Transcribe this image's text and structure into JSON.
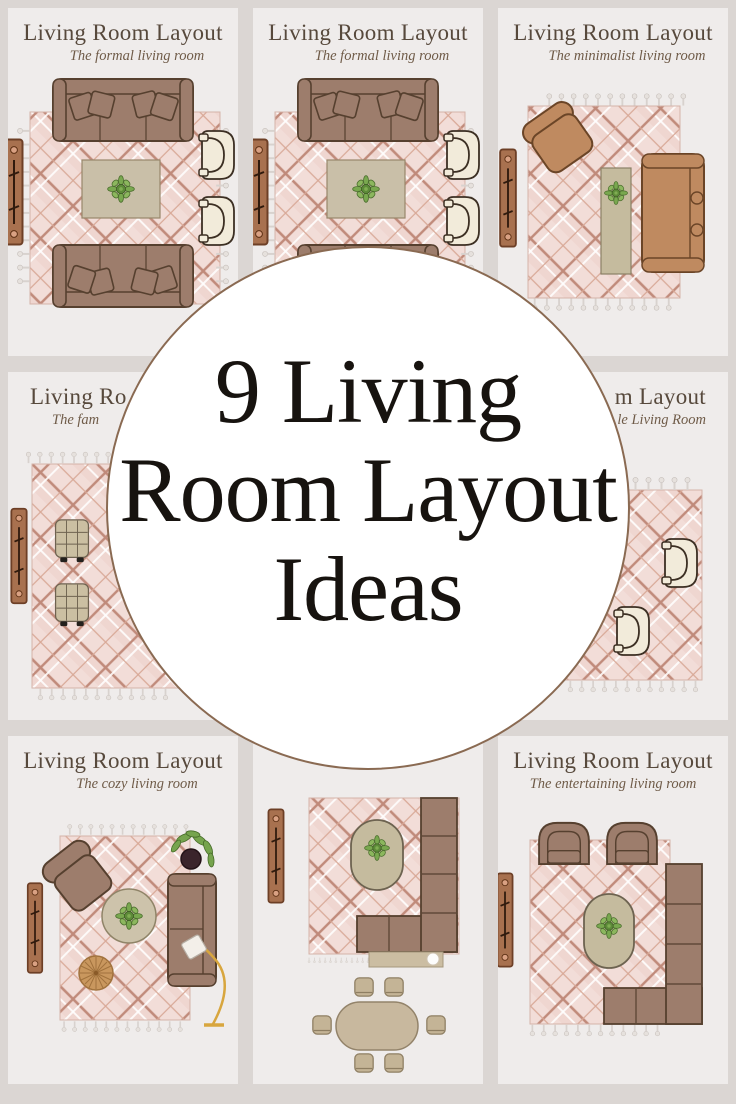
{
  "overlay": {
    "lines": [
      "9 Living",
      "Room Layout",
      "Ideas"
    ],
    "circle_fill": "#ffffff",
    "circle_border": "#8a6a52",
    "text_color": "#17130f"
  },
  "panels": [
    {
      "title": "Living Room Layout",
      "subtitle": "The formal living room",
      "furniture": [
        "plaid-rug",
        "sofa",
        "sofa",
        "coffee-table-with-plant",
        "accent-chair",
        "accent-chair",
        "console-table"
      ]
    },
    {
      "title": "Living Room Layout",
      "subtitle": "The formal living room",
      "furniture": [
        "plaid-rug",
        "sofa",
        "sofa",
        "coffee-table-with-plant",
        "accent-chair",
        "accent-chair",
        "console-table"
      ]
    },
    {
      "title": "Living Room Layout",
      "subtitle": "The minimalist living room",
      "furniture": [
        "plaid-rug",
        "swivel-accent-chair",
        "narrow-coffee-table-with-plant",
        "sofa",
        "console-table"
      ]
    },
    {
      "title": "Living Ro",
      "subtitle": "The fam",
      "furniture": [
        "plaid-rug",
        "tufted-ottoman",
        "tufted-ottoman",
        "console-table"
      ]
    },
    {
      "title": "",
      "subtitle": "",
      "furniture": []
    },
    {
      "title": "m Layout",
      "subtitle": "le Living Room",
      "furniture": [
        "plaid-rug",
        "accent-chair",
        "accent-chair"
      ]
    },
    {
      "title": "Living Room Layout",
      "subtitle": "The cozy living room",
      "furniture": [
        "plaid-rug",
        "armchair",
        "sofa",
        "round-coffee-table-with-plant",
        "pleated-pouf",
        "arc-floor-lamp",
        "potted-plant",
        "console-table"
      ]
    },
    {
      "title": "",
      "subtitle": "",
      "furniture": [
        "plaid-rug",
        "l-shaped-sectional",
        "oval-coffee-table-with-plant",
        "console-table",
        "sofa-table-with-lamp",
        "oval-dining-table",
        "dining-chair-x6"
      ]
    },
    {
      "title": "Living Room Layout",
      "subtitle": "The entertaining living room",
      "furniture": [
        "plaid-rug",
        "armchair",
        "armchair",
        "l-shaped-sectional",
        "oval-coffee-table-with-plant",
        "console-table"
      ]
    }
  ],
  "colors": {
    "page_background": "#dbd6d3",
    "panel_background": "#efeceb",
    "title_text": "#57493c",
    "subtitle_text": "#6f5b48",
    "sofa_brown": "#9d7d6c",
    "sofa_outline": "#56402f",
    "caramel": "#bf8a60",
    "rug_pink": "#f2ddd8",
    "plaid_line": "#c08a7a",
    "cream_chair": "#f2ebda",
    "console_wood": "#a8714f",
    "table_beige": "#c9bfa8",
    "plant_green": "#79a84f",
    "lamp_gold": "#d8a63e"
  }
}
